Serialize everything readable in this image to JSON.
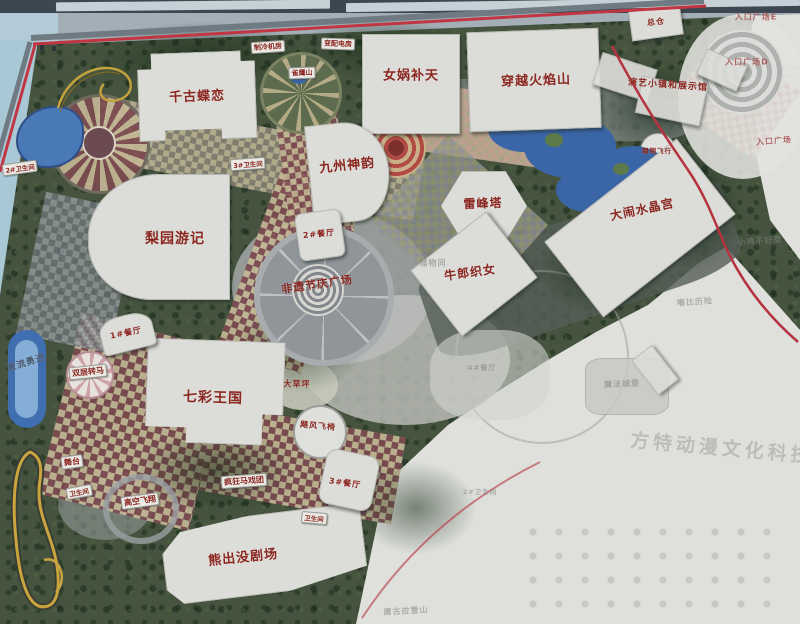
{
  "map_type": "theme-park-masterplan-photo",
  "colors": {
    "vegetation": "#46543f",
    "faded_zone": "#dfe0dc",
    "building": "#dcdcd8",
    "label_red": "#8b2620",
    "water": "#3a66a8",
    "trim_red": "#c23643",
    "checker_tan": "#c3b795",
    "checker_maroon": "#7c4a50",
    "frame_bar": "#3d4752"
  },
  "labels": {
    "qiangu": {
      "t": "千古蝶恋",
      "x": 197,
      "y": 95,
      "fs": 13,
      "rot": -2
    },
    "nuwa": {
      "t": "女娲补天",
      "x": 411,
      "y": 74,
      "fs": 13,
      "rot": 0
    },
    "huoyan": {
      "t": "穿越火焰山",
      "x": 536,
      "y": 79,
      "fs": 13,
      "rot": -2
    },
    "zongcang": {
      "t": "总仓",
      "x": 656,
      "y": 22,
      "fs": 8,
      "rot": -6
    },
    "liyuan": {
      "t": "梨园游记",
      "x": 175,
      "y": 238,
      "fs": 14,
      "rot": 0
    },
    "jiuzhou": {
      "t": "九州神韵",
      "x": 347,
      "y": 164,
      "fs": 13,
      "rot": -6
    },
    "canting2": {
      "t": "2#餐厅",
      "x": 319,
      "y": 234,
      "fs": 8,
      "rot": -6
    },
    "leifengta": {
      "t": "雷峰塔",
      "x": 483,
      "y": 203,
      "fs": 12,
      "rot": -2
    },
    "niulang": {
      "t": "牛郎织女",
      "x": 470,
      "y": 272,
      "fs": 12,
      "rot": -8
    },
    "shuijing": {
      "t": "大闹水晶宫",
      "x": 642,
      "y": 209,
      "fs": 12,
      "rot": -12
    },
    "feiyi": {
      "t": "非遗节庆广场",
      "x": 317,
      "y": 284,
      "fs": 11,
      "rot": -8
    },
    "qicai": {
      "t": "七彩王国",
      "x": 213,
      "y": 397,
      "fs": 14,
      "rot": 2
    },
    "canting1": {
      "t": "1#餐厅",
      "x": 126,
      "y": 333,
      "fs": 8,
      "rot": -12
    },
    "xiongchumo": {
      "t": "熊出没剧场",
      "x": 243,
      "y": 556,
      "fs": 13,
      "rot": -6
    },
    "canting3": {
      "t": "3#餐厅",
      "x": 345,
      "y": 483,
      "fs": 8,
      "rot": 8
    },
    "jufeng": {
      "t": "飓风飞椅",
      "x": 318,
      "y": 426,
      "fs": 8,
      "rot": 5
    },
    "fengkuang": {
      "t": "疯狂马戏团",
      "x": 244,
      "y": 481,
      "fs": 8,
      "rot": -4,
      "cls": "pill"
    },
    "shuangceng": {
      "t": "双层转马",
      "x": 88,
      "y": 372,
      "fs": 8,
      "rot": -6,
      "cls": "pill"
    },
    "wutai": {
      "t": "舞台",
      "x": 72,
      "y": 462,
      "fs": 8,
      "rot": -8,
      "cls": "pill"
    },
    "gaokong": {
      "t": "高空飞翔",
      "x": 140,
      "y": 501,
      "fs": 8,
      "rot": -8,
      "cls": "pill"
    },
    "aoxiang": {
      "t": "翱翔飞行",
      "x": 657,
      "y": 150,
      "fs": 6.5,
      "rot": 0
    },
    "yanyi": {
      "t": "演艺小镇和展示馆",
      "x": 668,
      "y": 84,
      "fs": 9,
      "rot": 4
    },
    "queying": {
      "t": "雀鹰山",
      "x": 302,
      "y": 73,
      "fs": 7,
      "rot": -2,
      "cls": "pill"
    },
    "zhileng": {
      "t": "制冷机房",
      "x": 268,
      "y": 47,
      "fs": 7,
      "rot": -4,
      "cls": "pill"
    },
    "bianpei": {
      "t": "变配电房",
      "x": 338,
      "y": 44,
      "fs": 7,
      "rot": 2,
      "cls": "pill"
    },
    "dacaoping": {
      "t": "大草坪",
      "x": 297,
      "y": 384,
      "fs": 8,
      "rot": 0
    },
    "jiliu": {
      "t": "激流勇进",
      "x": 26,
      "y": 362,
      "fs": 9,
      "rot": -18,
      "cls": "water"
    },
    "wc2": {
      "t": "2#卫生间",
      "x": 20,
      "y": 168,
      "fs": 6.5,
      "rot": -8,
      "cls": "pill"
    },
    "wc3": {
      "t": "3#卫生间",
      "x": 248,
      "y": 164,
      "fs": 6.5,
      "rot": -4,
      "cls": "pill"
    },
    "wcA": {
      "t": "卫生间",
      "x": 79,
      "y": 492,
      "fs": 6.5,
      "rot": -10,
      "cls": "pill"
    },
    "wcB": {
      "t": "卫生间",
      "x": 314,
      "y": 518,
      "fs": 6.5,
      "rot": 5,
      "cls": "pill"
    },
    "plazaE": {
      "t": "入口广场E",
      "x": 756,
      "y": 17,
      "fs": 8,
      "rot": 0,
      "cls": "entr"
    },
    "plazaD": {
      "t": "入口广场D",
      "x": 747,
      "y": 62,
      "fs": 8,
      "rot": 0,
      "cls": "entr"
    },
    "plazaMain": {
      "t": "入口广场",
      "x": 774,
      "y": 141,
      "fs": 8,
      "rot": -4,
      "cls": "entr"
    },
    "chuwu": {
      "t": "储物间",
      "x": 433,
      "y": 263,
      "fs": 8,
      "rot": 0,
      "cls": "faded"
    },
    "canting4": {
      "t": "4#餐厅",
      "x": 482,
      "y": 368,
      "fs": 7,
      "rot": 0,
      "cls": "faded"
    },
    "wcF": {
      "t": "2#卫生间",
      "x": 480,
      "y": 491,
      "fs": 6.5,
      "rot": 0,
      "cls": "faded"
    },
    "mofa": {
      "t": "魔法城堡",
      "x": 622,
      "y": 384,
      "fs": 8,
      "rot": -2,
      "cls": "faded"
    },
    "xiaoji": {
      "t": "小鸡不好惹",
      "x": 760,
      "y": 241,
      "fs": 8,
      "rot": -4,
      "cls": "faded"
    },
    "dubi": {
      "t": "嘟比历险",
      "x": 695,
      "y": 302,
      "fs": 8,
      "rot": -4,
      "cls": "faded"
    },
    "tanggula": {
      "t": "唐古拉雪山",
      "x": 406,
      "y": 611,
      "fs": 8,
      "rot": -3,
      "cls": "faded"
    },
    "wm": {
      "t": "方特动漫文化科技",
      "x": 722,
      "y": 447,
      "fs": 19,
      "rot": 5,
      "cls": "wm"
    },
    "yin": {
      "t": "音",
      "x": 790,
      "y": 78,
      "fs": 34,
      "rot": 0,
      "cls": "big"
    }
  }
}
